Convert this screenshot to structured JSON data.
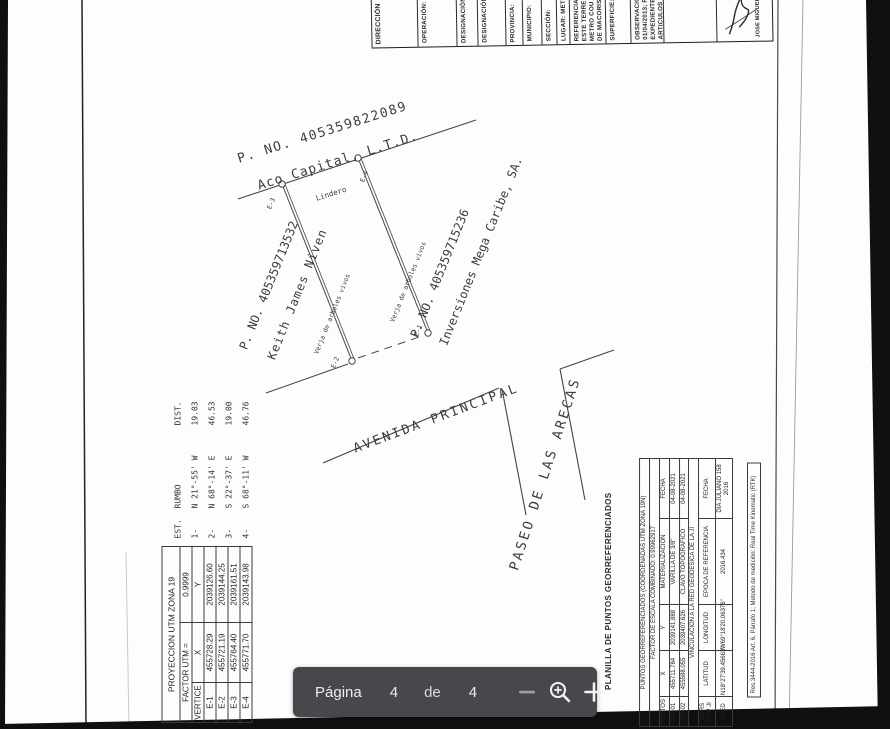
{
  "toolbar": {
    "page_label": "Página",
    "current_page": "4",
    "of_label": "de",
    "total_pages": "4",
    "bg": "#47484b"
  },
  "plan": {
    "labels": {
      "north_parcel": "P. NO. 405359822089",
      "north_owner": "Aco Capital, L.T.D.",
      "lindero": "Lindero",
      "west_parcel": "P. NO. 405359713532",
      "west_owner": "Keith James Niven",
      "east_parcel": "P. NO. 405359715236",
      "east_owner": "Inversiones Mega Caribe, SA.",
      "fence_west": "Verja de arboles vivos",
      "fence_east": "Verja de arboles vivos",
      "street_main": "AVENIDA PRINCIPAL",
      "street_cross": "PASEO DE LAS ARECAS",
      "v1": "E-1",
      "v2": "E-2",
      "v3": "E-3",
      "v4": "E-4"
    },
    "bearings": {
      "headers": [
        "EST.",
        "RUMBO",
        "DIST."
      ],
      "rows": [
        [
          "1-",
          "N 21°-55' W",
          "19.03"
        ],
        [
          "2-",
          "N 68°-14' E",
          "46.53"
        ],
        [
          "3-",
          "S 22°-37' E",
          "19.00"
        ],
        [
          "4-",
          "S 68°-11' W",
          "46.76"
        ]
      ]
    },
    "utm": {
      "title": "PROYECCION UTM ZONA 19",
      "factor_label": "FACTOR UTM =",
      "factor_value": "0.9999",
      "headers": [
        "VERTICE",
        "X",
        "Y"
      ],
      "rows": [
        [
          "E-1",
          "455728.29",
          "2039126.60"
        ],
        [
          "E-2",
          "455721.19",
          "2039144.25"
        ],
        [
          "E-3",
          "455764.40",
          "2039161.51"
        ],
        [
          "E-4",
          "455771.70",
          "2039143.98"
        ]
      ]
    },
    "georef": {
      "side_title": "PLANILLA DE PUNTOS GEORREFERENCIADOS",
      "title": "PUNTOS GEORREFERENCIADOS (COORDENADAS UTM ZONA 19N)",
      "scale": "FACTOR DE ESCALA COMBINADO: 0.99962917",
      "headers": [
        "PUNTOS",
        "X",
        "Y",
        "MATERIALIZACION",
        "FECHA"
      ],
      "rows": [
        [
          "PG-01",
          "455711.784",
          "2039141.888",
          "VARILLA DE 3/8\"",
          "04-08-2021"
        ],
        [
          "PG-02",
          "455588.055",
          "2039407.626",
          "CLAVO TOPOGRAFICO",
          "04-08-2021"
        ]
      ],
      "link": "VINCULACION A LA RED GEODESICA DE LA JI",
      "headers2": [
        "CORS REP JI",
        "LATITUD",
        "LONGITUD",
        "EPOCA DE REFERENCIA",
        "FECHA"
      ],
      "rows2": [
        [
          "SPED",
          "N18°27'39.45663\"",
          "W69°18'20.06376\"",
          "2016.434",
          "DIA JULIANO 158 2016"
        ]
      ],
      "note": "Res.3444-2016 Art. 6, Párrafo 1; Metodo de medición: Real Time Kinematic (RTK)"
    },
    "titleblock": {
      "cells": [
        "DIRECCIÓN",
        "OPERACIÓN:",
        "DESIGNACIÓN:",
        "DESIGNACIÓN:",
        "PROVINCIA:",
        "MUNICIPIO:",
        "SECCIÓN:",
        "LUGAR: MET",
        "REFERENCIA:\nESTE TERRE\nMETRO COU\nDE MACORIS",
        "SUPERFICIE:",
        "OBSERVACIO\n01/04/2013; R\nEXPEDIENTE\nARTICULOS",
        "",
        "JOSE MIGUEL"
      ]
    }
  }
}
